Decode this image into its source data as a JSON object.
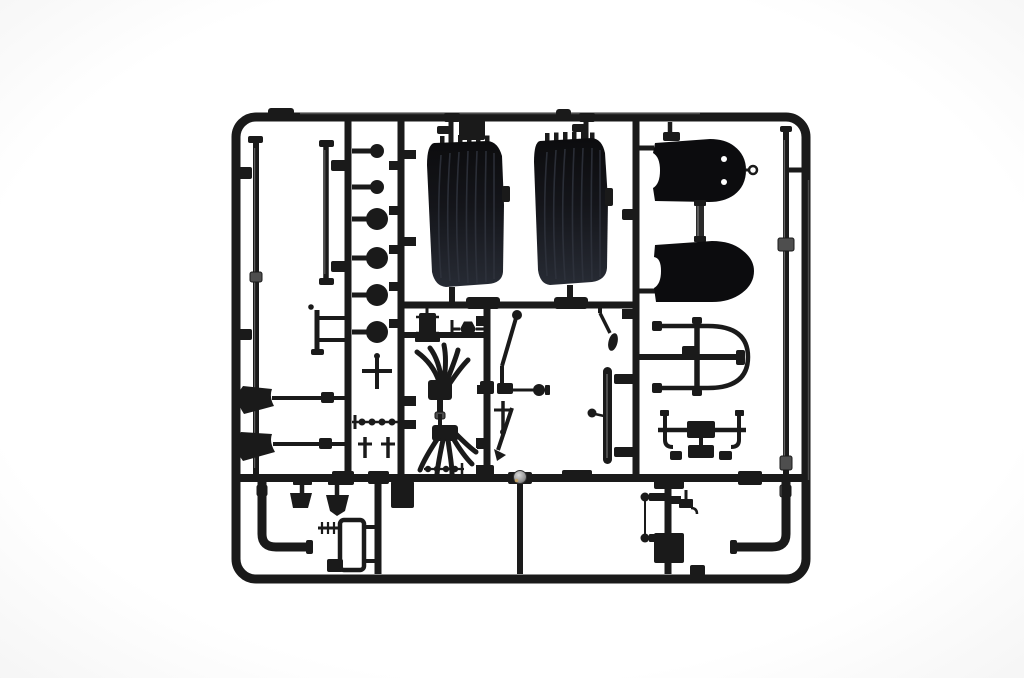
{
  "photo": {
    "alt": "Black plastic model kit sprue (parts tree) photographed on a white background"
  },
  "colors": {
    "bg": "#ffffff",
    "bg_edge": "#f4f4f4",
    "plastic": "#1a1a1a",
    "plastic_deep": "#0c0c0e",
    "plastic_soft": "#272b34",
    "rib": "#2f333d",
    "highlight": "#7d7d7d",
    "metal_band": "#4e4e4e",
    "sphere": "#9a9a9a",
    "sphere_glint": "#c9a35f",
    "hole": "#ffffff"
  },
  "parts": [
    "sprue-frame",
    "mid-runner",
    "vertical-runners",
    "seat-back-left",
    "seat-back-right",
    "plate-part",
    "panel-oval-top",
    "panel-oval-bottom",
    "windshield-hoop",
    "bumper-bracket",
    "hub-knobs",
    "horn-funnel-1",
    "horn-funnel-2",
    "mount-bracket",
    "carburetor",
    "hex-ball-joint",
    "exhaust-manifold-upper",
    "exhaust-manifold-lower",
    "gear-lever",
    "linkage-assembly",
    "t-pin-part",
    "lever-2",
    "hanging-lever",
    "leaf-spring",
    "ball-stud",
    "long-rod-left",
    "short-rod-left",
    "right-rod",
    "rod-clip",
    "pedal-1",
    "pedal-2",
    "exhaust-pipe-left",
    "exhaust-pipe-right",
    "comb-part",
    "loop-bracket",
    "block-part",
    "bead-strip",
    "cross-part",
    "bead-rod",
    "tie-rod",
    "valve-part",
    "box-part",
    "gate-sphere"
  ]
}
